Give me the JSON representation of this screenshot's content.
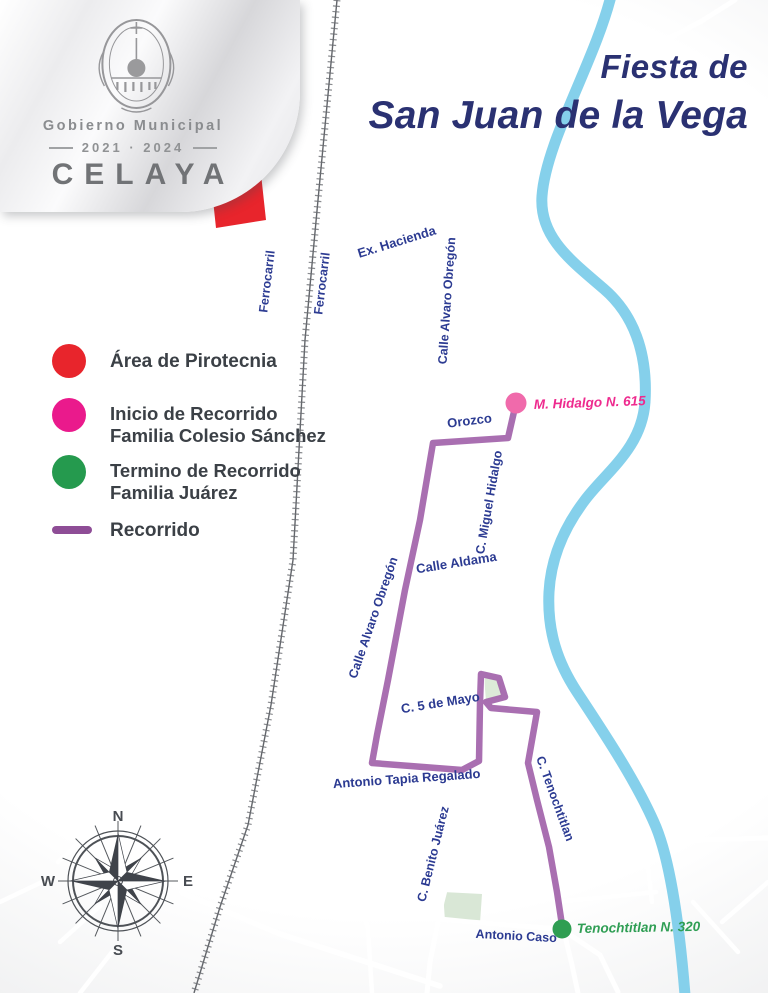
{
  "poster": {
    "title_line1": "Fiesta de",
    "title_line2": "San Juan de la Vega"
  },
  "logo": {
    "government": "Gobierno Municipal",
    "period": "2021 · 2024",
    "city": "CELAYA"
  },
  "legend": {
    "items": [
      {
        "id": "pirotecnia",
        "label": "Área de Pirotecnia",
        "color": "#e8252c",
        "marker": "circle"
      },
      {
        "id": "inicio",
        "label_line1": "Inicio de Recorrido",
        "label_line2": "Familia Colesio Sánchez",
        "color": "#ea1a8c",
        "marker": "circle"
      },
      {
        "id": "termino",
        "label_line1": "Termino de Recorrido",
        "label_line2": "Familia Juárez",
        "color": "#259a4e",
        "marker": "circle"
      },
      {
        "id": "recorrido",
        "label": "Recorrido",
        "color": "#a263aa",
        "marker": "line"
      }
    ]
  },
  "map": {
    "street_labels": [
      {
        "id": "ferrocarril-west",
        "text": "Ferrocarril"
      },
      {
        "id": "ferrocarril-east",
        "text": "Ferrocarril"
      },
      {
        "id": "ex-hacienda",
        "text": "Ex. Hacienda"
      },
      {
        "id": "alvaro-obregon-north",
        "text": "Calle Alvaro Obregón"
      },
      {
        "id": "orozco",
        "text": "Orozco"
      },
      {
        "id": "miguel-hidalgo",
        "text": "C. Miguel Hidalgo"
      },
      {
        "id": "calle-aldama",
        "text": "Calle Aldama"
      },
      {
        "id": "alvaro-obregon-south",
        "text": "Calle Alvaro Obregón"
      },
      {
        "id": "cinco-de-mayo",
        "text": "C. 5 de Mayo"
      },
      {
        "id": "antonio-tapia-regalado",
        "text": "Antonio Tapia Regalado"
      },
      {
        "id": "benito-juarez",
        "text": "C. Benito Juárez"
      },
      {
        "id": "tenochtitlan",
        "text": "C. Tenochtitlan"
      },
      {
        "id": "antonio-caso",
        "text": "Antonio Caso"
      }
    ],
    "points": {
      "start": {
        "label": "M. Hidalgo N. 615",
        "color": "#ee2a8e"
      },
      "end": {
        "label": "Tenochtitlan N. 320",
        "color": "#2f9e54"
      }
    },
    "compass": {
      "n": "N",
      "e": "E",
      "s": "S",
      "w": "W"
    }
  },
  "colors": {
    "background": "#d6d8db",
    "streets": "#ffffff",
    "river": "#7ecdea",
    "railway": "#63666b",
    "route": "#a263aa",
    "pyrotechnics_area": "#e8252c",
    "start_marker": "#f06aab",
    "end_marker": "#2f9e52",
    "street_label": "#2c3b92",
    "title": "#2a3172",
    "legend_text": "#3b4046"
  }
}
